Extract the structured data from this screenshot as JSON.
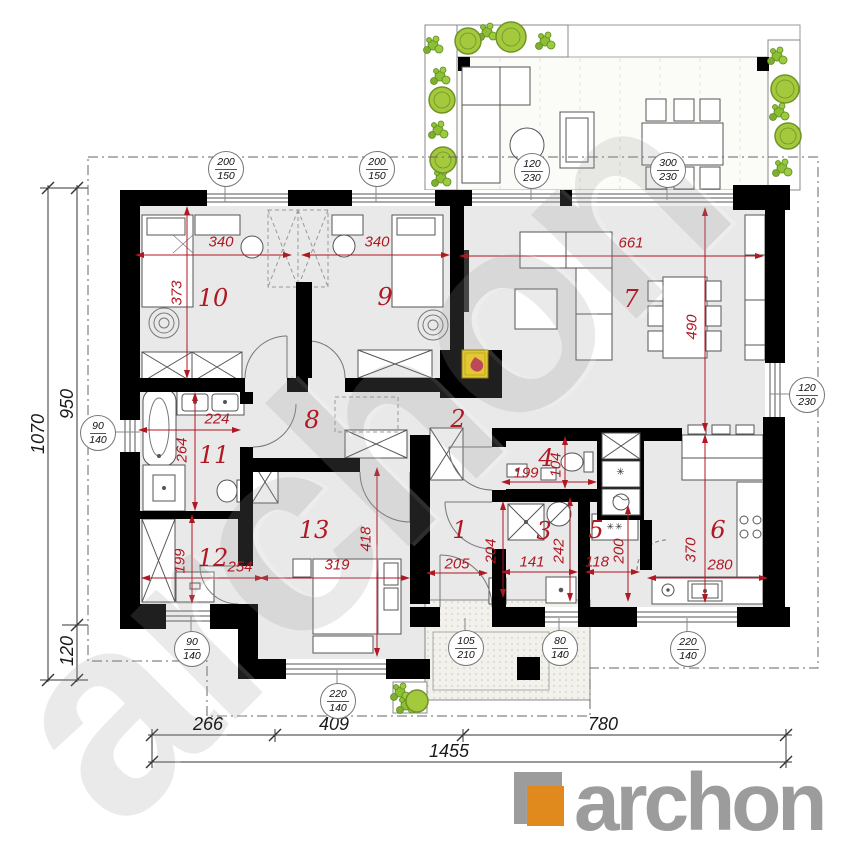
{
  "watermark": "archon",
  "logo": {
    "brand": "archon"
  },
  "rooms": {
    "n1": "1",
    "n2": "2",
    "n3": "3",
    "n4": "4",
    "n5": "5",
    "n6": "6",
    "n7": "7",
    "n8": "8",
    "n9": "9",
    "n10": "10",
    "n11": "11",
    "n12": "12",
    "n13": "13"
  },
  "dims": {
    "d340a": "340",
    "d340b": "340",
    "d373": "373",
    "d661": "661",
    "d490": "490",
    "d224": "224",
    "d264": "264",
    "d199a": "199",
    "d254": "254",
    "d319": "319",
    "d418": "418",
    "d205": "205",
    "d204": "204",
    "d141": "141",
    "d242": "242",
    "d199b": "199",
    "d104": "104",
    "d118": "118",
    "d200": "200",
    "d370": "370",
    "d280": "280"
  },
  "badges": {
    "b1": {
      "top": "200",
      "bottom": "150"
    },
    "b2": {
      "top": "200",
      "bottom": "150"
    },
    "b3": {
      "top": "120",
      "bottom": "230"
    },
    "b4": {
      "top": "300",
      "bottom": "230"
    },
    "b5": {
      "top": "90",
      "bottom": "140"
    },
    "b6": {
      "top": "120",
      "bottom": "230"
    },
    "b7": {
      "top": "90",
      "bottom": "140"
    },
    "b8": {
      "top": "220",
      "bottom": "140"
    },
    "b9": {
      "top": "105",
      "bottom": "210"
    },
    "b10": {
      "top": "80",
      "bottom": "140"
    },
    "b11": {
      "top": "220",
      "bottom": "140"
    }
  },
  "outer": {
    "left_total": "1070",
    "left_main": "950",
    "left_low": "120",
    "bottom_a": "266",
    "bottom_b": "409",
    "bottom_c": "780",
    "bottom_total": "1455"
  },
  "icons": {
    "appliance_star": "✳",
    "washer_stars": "✳✳"
  },
  "colors": {
    "dimension_red": "#B01823",
    "plan_green": "#8CBF33",
    "logo_orange": "#E08A1E",
    "logo_gray": "#9C9C9C",
    "wall_black": "#000000",
    "floor_gray": "#E9E9E9"
  }
}
